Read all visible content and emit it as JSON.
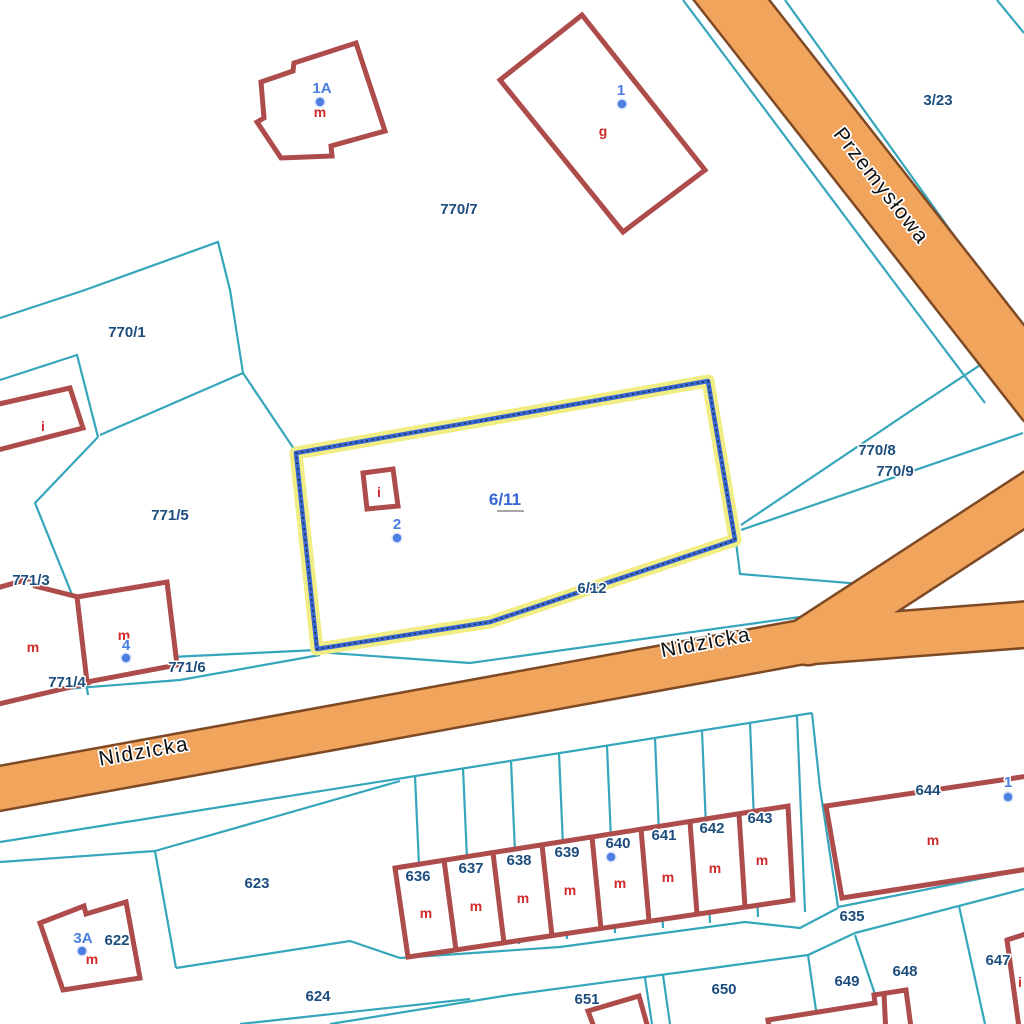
{
  "map": {
    "kind": "cadastral-parcel-map",
    "selected_parcel": "6/11"
  },
  "colors": {
    "background": "#ffffff",
    "parcel_line": "#35a6bb",
    "road_fill": "#f0a45c",
    "road_edge": "#7e4a26",
    "building_stroke": "#ae4c4c",
    "parcel_label": "#1c4d7d",
    "address_label": "#4a7de0",
    "address_dot": "#4d7fe3",
    "building_letter": "#cf2b2b",
    "selection_halo": "#f1ed85",
    "selection_line": "#3766d4",
    "selection_dots": "#222222",
    "street_text": "#111111",
    "halo": "#ffffff"
  },
  "streets": [
    {
      "name": "Przemysłowa",
      "x": 876,
      "y": 190,
      "rot": 52
    },
    {
      "name": "Nidzicka",
      "x": 145,
      "y": 758,
      "rot": -10
    },
    {
      "name": "Nidzicka",
      "x": 707,
      "y": 649,
      "rot": -10.6
    }
  ],
  "roads": [
    {
      "id": "przemyslowa",
      "pts": [
        [
          708,
          -30
        ],
        [
          1045,
          400
        ]
      ],
      "w": 57
    },
    {
      "id": "nidzicka-main",
      "pts": [
        [
          -20,
          792
        ],
        [
          830,
          637
        ]
      ],
      "w": 42
    },
    {
      "id": "nidzicka-branch-upper",
      "pts": [
        [
          808,
          641
        ],
        [
          1060,
          477
        ]
      ],
      "w": 46
    },
    {
      "id": "nidzicka-branch-lower",
      "pts": [
        [
          812,
          641
        ],
        [
          1060,
          622
        ]
      ],
      "w": 44
    }
  ],
  "parcel_lines": [
    [
      [
        785,
        0
      ],
      [
        1024,
        333
      ]
    ],
    [
      [
        683,
        0
      ],
      [
        900,
        290
      ],
      [
        985,
        403
      ]
    ],
    [
      [
        997,
        0
      ],
      [
        1024,
        33
      ]
    ],
    [
      [
        0,
        318
      ],
      [
        85,
        290
      ],
      [
        218,
        242
      ],
      [
        230,
        290
      ],
      [
        243,
        373
      ]
    ],
    [
      [
        243,
        373
      ],
      [
        100,
        435
      ]
    ],
    [
      [
        0,
        380
      ],
      [
        77,
        355
      ],
      [
        98,
        437
      ]
    ],
    [
      [
        98,
        437
      ],
      [
        35,
        503
      ],
      [
        73,
        597
      ],
      [
        88,
        695
      ]
    ],
    [
      [
        243,
        373
      ],
      [
        296,
        452
      ],
      [
        312,
        650
      ]
    ],
    [
      [
        0,
        664
      ],
      [
        150,
        658
      ],
      [
        317,
        650
      ]
    ],
    [
      [
        0,
        694
      ],
      [
        180,
        680
      ],
      [
        320,
        655
      ]
    ],
    [
      [
        317,
        652
      ],
      [
        470,
        663
      ],
      [
        800,
        617
      ],
      [
        862,
        604
      ]
    ],
    [
      [
        736,
        542
      ],
      [
        740,
        574
      ],
      [
        910,
        588
      ]
    ],
    [
      [
        741,
        525
      ],
      [
        912,
        410
      ],
      [
        1000,
        352
      ]
    ],
    [
      [
        741,
        530
      ],
      [
        1023,
        433
      ]
    ],
    [
      [
        0,
        842
      ],
      [
        812,
        713
      ]
    ],
    [
      [
        812,
        713
      ],
      [
        820,
        788
      ],
      [
        838,
        907
      ]
    ],
    [
      [
        838,
        907
      ],
      [
        1024,
        870
      ]
    ],
    [
      [
        855,
        933
      ],
      [
        1024,
        889
      ]
    ],
    [
      [
        330,
        1024
      ],
      [
        510,
        995
      ],
      [
        720,
        967
      ],
      [
        808,
        955
      ],
      [
        855,
        933
      ]
    ],
    [
      [
        808,
        955
      ],
      [
        818,
        1024
      ]
    ],
    [
      [
        855,
        935
      ],
      [
        885,
        1024
      ]
    ],
    [
      [
        959,
        906
      ],
      [
        985,
        1024
      ]
    ],
    [
      [
        400,
        958
      ],
      [
        560,
        947
      ],
      [
        745,
        922
      ],
      [
        800,
        928
      ],
      [
        838,
        908
      ]
    ],
    [
      [
        155,
        851
      ],
      [
        176,
        968
      ]
    ],
    [
      [
        176,
        968
      ],
      [
        350,
        941
      ],
      [
        400,
        958
      ]
    ],
    [
      [
        155,
        851
      ],
      [
        400,
        781
      ]
    ],
    [
      [
        0,
        862
      ],
      [
        155,
        851
      ]
    ],
    [
      [
        240,
        1024
      ],
      [
        470,
        999
      ]
    ],
    [
      [
        645,
        978
      ],
      [
        652,
        1024
      ]
    ],
    [
      [
        663,
        975
      ],
      [
        670,
        1024
      ]
    ],
    [
      [
        415,
        776
      ],
      [
        423,
        955
      ]
    ],
    [
      [
        463,
        768
      ],
      [
        471,
        950
      ]
    ],
    [
      [
        511,
        761
      ],
      [
        519,
        944
      ]
    ],
    [
      [
        559,
        753
      ],
      [
        567,
        939
      ]
    ],
    [
      [
        607,
        746
      ],
      [
        615,
        933
      ]
    ],
    [
      [
        655,
        738
      ],
      [
        663,
        928
      ]
    ],
    [
      [
        702,
        731
      ],
      [
        710,
        923
      ]
    ],
    [
      [
        750,
        723
      ],
      [
        758,
        917
      ]
    ],
    [
      [
        797,
        716
      ],
      [
        805,
        912
      ]
    ]
  ],
  "buildings": [
    {
      "id": "house-1A",
      "d": "M261,82 L293,71 L294,63 L356,43 L385,131 L331,146 L332,156 L281,158 L257,122 L264,118 Z"
    },
    {
      "id": "barn-g",
      "d": "M582,15 L705,170 L623,232 L500,80 Z"
    },
    {
      "id": "building-i-west",
      "d": "M-10,406 L70,388 L83,428 L-10,452 Z"
    },
    {
      "id": "building-m-west",
      "d": "M-10,590 L32,578 L35,586 L78,597 L88,683 L-10,706 Z"
    },
    {
      "id": "house-4",
      "d": "M77,597 L167,582 L177,665 L87,682 Z"
    },
    {
      "id": "building-i-selected",
      "d": "M363,473 L393,469 L398,506 L367,509 Z"
    },
    {
      "id": "house-3A",
      "d": "M40,923 L84,906 L86,914 L126,902 L140,978 L63,990 Z"
    },
    {
      "id": "building-644",
      "d": "M826,806 L1035,775 L1035,868 L842,898 Z"
    },
    {
      "id": "building-651",
      "d": "M588,1011 L639,996 L650,1035 L597,1035 Z"
    },
    {
      "id": "building-649",
      "d": "M768,1020 L875,1003 L874,995 L906,990 L912,1035 L770,1035 Z"
    },
    {
      "id": "building-649-divider",
      "d": "M884,994 L886,1035",
      "open": true
    },
    {
      "id": "building-647",
      "d": "M1035,931 L1007,940 L1020,1035 L1035,1035 Z"
    },
    {
      "id": "terrace-row",
      "d": "M395,868 L788,806 L793,900 L408,957 Z"
    },
    {
      "id": "terrace-divider",
      "d": "M444,860 L456,950",
      "open": true
    },
    {
      "id": "terrace-divider",
      "d": "M493,853 L504,943",
      "open": true
    },
    {
      "id": "terrace-divider",
      "d": "M542,845 L552,936",
      "open": true
    },
    {
      "id": "terrace-divider",
      "d": "M592,837 L601,929",
      "open": true
    },
    {
      "id": "terrace-divider",
      "d": "M641,829 L649,921",
      "open": true
    },
    {
      "id": "terrace-divider",
      "d": "M690,822 L697,914",
      "open": true
    },
    {
      "id": "terrace-divider",
      "d": "M739,814 L745,907",
      "open": true
    }
  ],
  "selection": {
    "parcel": "6/11",
    "pts": [
      [
        296,
        453
      ],
      [
        708,
        381
      ],
      [
        735,
        540
      ],
      [
        490,
        622
      ],
      [
        317,
        649
      ]
    ],
    "label": {
      "text": "6/11",
      "x": 505,
      "y": 505
    },
    "underline": {
      "x1": 497,
      "x2": 524,
      "y": 511
    }
  },
  "parcel_labels": [
    {
      "text": "770/7",
      "x": 459,
      "y": 214
    },
    {
      "text": "3/23",
      "x": 938,
      "y": 105
    },
    {
      "text": "770/1",
      "x": 127,
      "y": 337
    },
    {
      "text": "771/5",
      "x": 170,
      "y": 520
    },
    {
      "text": "771/3",
      "x": 31,
      "y": 585
    },
    {
      "text": "771/4",
      "x": 67,
      "y": 687
    },
    {
      "text": "771/6",
      "x": 187,
      "y": 672
    },
    {
      "text": "770/8",
      "x": 877,
      "y": 455
    },
    {
      "text": "770/9",
      "x": 895,
      "y": 476
    },
    {
      "text": "6/12",
      "x": 592,
      "y": 593
    },
    {
      "text": "623",
      "x": 257,
      "y": 888
    },
    {
      "text": "622",
      "x": 117,
      "y": 945
    },
    {
      "text": "624",
      "x": 318,
      "y": 1001
    },
    {
      "text": "636",
      "x": 418,
      "y": 881
    },
    {
      "text": "637",
      "x": 471,
      "y": 873
    },
    {
      "text": "638",
      "x": 519,
      "y": 865
    },
    {
      "text": "639",
      "x": 567,
      "y": 857
    },
    {
      "text": "640",
      "x": 618,
      "y": 848
    },
    {
      "text": "641",
      "x": 664,
      "y": 840
    },
    {
      "text": "642",
      "x": 712,
      "y": 833
    },
    {
      "text": "643",
      "x": 760,
      "y": 823
    },
    {
      "text": "644",
      "x": 928,
      "y": 795
    },
    {
      "text": "635",
      "x": 852,
      "y": 921
    },
    {
      "text": "651",
      "x": 587,
      "y": 1004
    },
    {
      "text": "650",
      "x": 724,
      "y": 994
    },
    {
      "text": "649",
      "x": 847,
      "y": 986
    },
    {
      "text": "648",
      "x": 905,
      "y": 976
    },
    {
      "text": "647",
      "x": 998,
      "y": 965
    }
  ],
  "labels_under_roads": [
    {
      "text": "1",
      "x": 917,
      "y": 226,
      "type": "address"
    },
    {
      "text": "7",
      "x": 991,
      "y": 364,
      "type": "parcel"
    }
  ],
  "address_points": [
    {
      "text": "1A",
      "x": 322,
      "y": 93,
      "dot": [
        320,
        102
      ]
    },
    {
      "text": "1",
      "x": 621,
      "y": 95,
      "dot": [
        622,
        104
      ]
    },
    {
      "text": "2",
      "x": 397,
      "y": 529,
      "dot": [
        397,
        538
      ]
    },
    {
      "text": "4",
      "x": 126,
      "y": 650,
      "dot": [
        126,
        658
      ]
    },
    {
      "text": "1",
      "x": 1008,
      "y": 787,
      "dot": [
        1008,
        797
      ]
    },
    {
      "text": "3A",
      "x": 83,
      "y": 943,
      "dot": [
        82,
        951
      ]
    },
    {
      "text": "",
      "x": 611,
      "y": 857,
      "dot": [
        611,
        857
      ]
    }
  ],
  "building_letters": [
    {
      "text": "m",
      "x": 320,
      "y": 117
    },
    {
      "text": "g",
      "x": 603,
      "y": 136
    },
    {
      "text": "i",
      "x": 43,
      "y": 431
    },
    {
      "text": "i",
      "x": 379,
      "y": 497
    },
    {
      "text": "m",
      "x": 33,
      "y": 652
    },
    {
      "text": "m",
      "x": 124,
      "y": 640
    },
    {
      "text": "m",
      "x": 426,
      "y": 918
    },
    {
      "text": "m",
      "x": 476,
      "y": 911
    },
    {
      "text": "m",
      "x": 523,
      "y": 903
    },
    {
      "text": "m",
      "x": 570,
      "y": 895
    },
    {
      "text": "m",
      "x": 620,
      "y": 888
    },
    {
      "text": "m",
      "x": 668,
      "y": 882
    },
    {
      "text": "m",
      "x": 715,
      "y": 873
    },
    {
      "text": "m",
      "x": 762,
      "y": 865
    },
    {
      "text": "m",
      "x": 933,
      "y": 845
    },
    {
      "text": "m",
      "x": 92,
      "y": 964
    },
    {
      "text": "i",
      "x": 1020,
      "y": 987
    }
  ]
}
